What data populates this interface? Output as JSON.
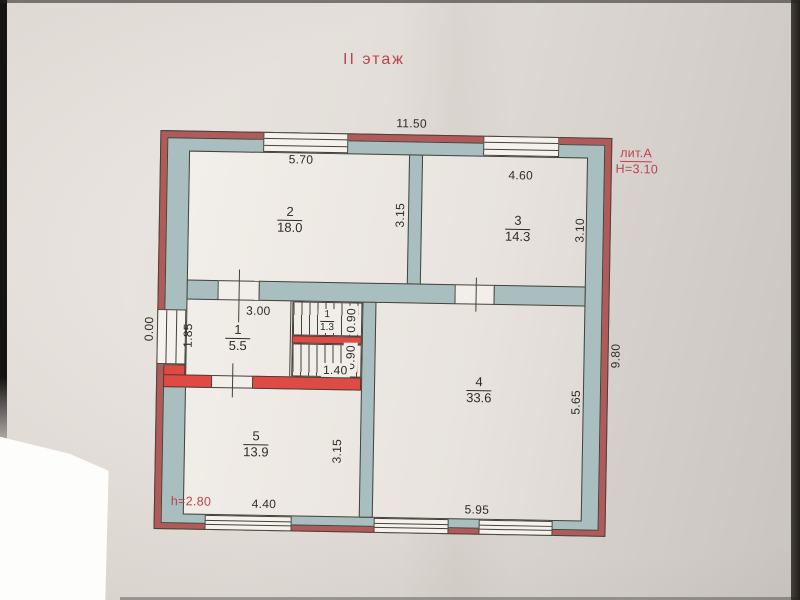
{
  "page": {
    "title": "II этаж"
  },
  "stamp": {
    "liter": "лит.А",
    "building_height": "H=3.10",
    "ceiling_height": "h=2.80"
  },
  "rooms": {
    "r1": {
      "number": "1",
      "area": "5.5"
    },
    "r2": {
      "number": "2",
      "area": "18.0"
    },
    "r3": {
      "number": "3",
      "area": "14.3"
    },
    "r4": {
      "number": "4",
      "area": "33.6"
    },
    "r5": {
      "number": "5",
      "area": "13.9"
    },
    "stair": {
      "number": "1",
      "area": "1.3"
    }
  },
  "dims": {
    "top_total": "11.50",
    "room2_width": "5.70",
    "room3_width": "4.60",
    "room2_depth": "3.15",
    "room3_depth": "3.10",
    "hall_width": "3.00",
    "hall_depth": "1.85",
    "left_zero": "0.00",
    "stair_upper_width": "0.90",
    "stair_lower_width": "0.90",
    "stair_length": "1.40",
    "room4_depth": "5.65",
    "right_total": "9.80",
    "room5_depth": "3.15",
    "room5_width": "4.40",
    "room4_width": "5.95"
  },
  "colors": {
    "wall_fill": "#a9bebe",
    "outer_red": "#b05a5a",
    "partition_red": "#e04a44",
    "red_text": "#b8444e",
    "ink": "#2e2b28",
    "line": "#454139"
  }
}
